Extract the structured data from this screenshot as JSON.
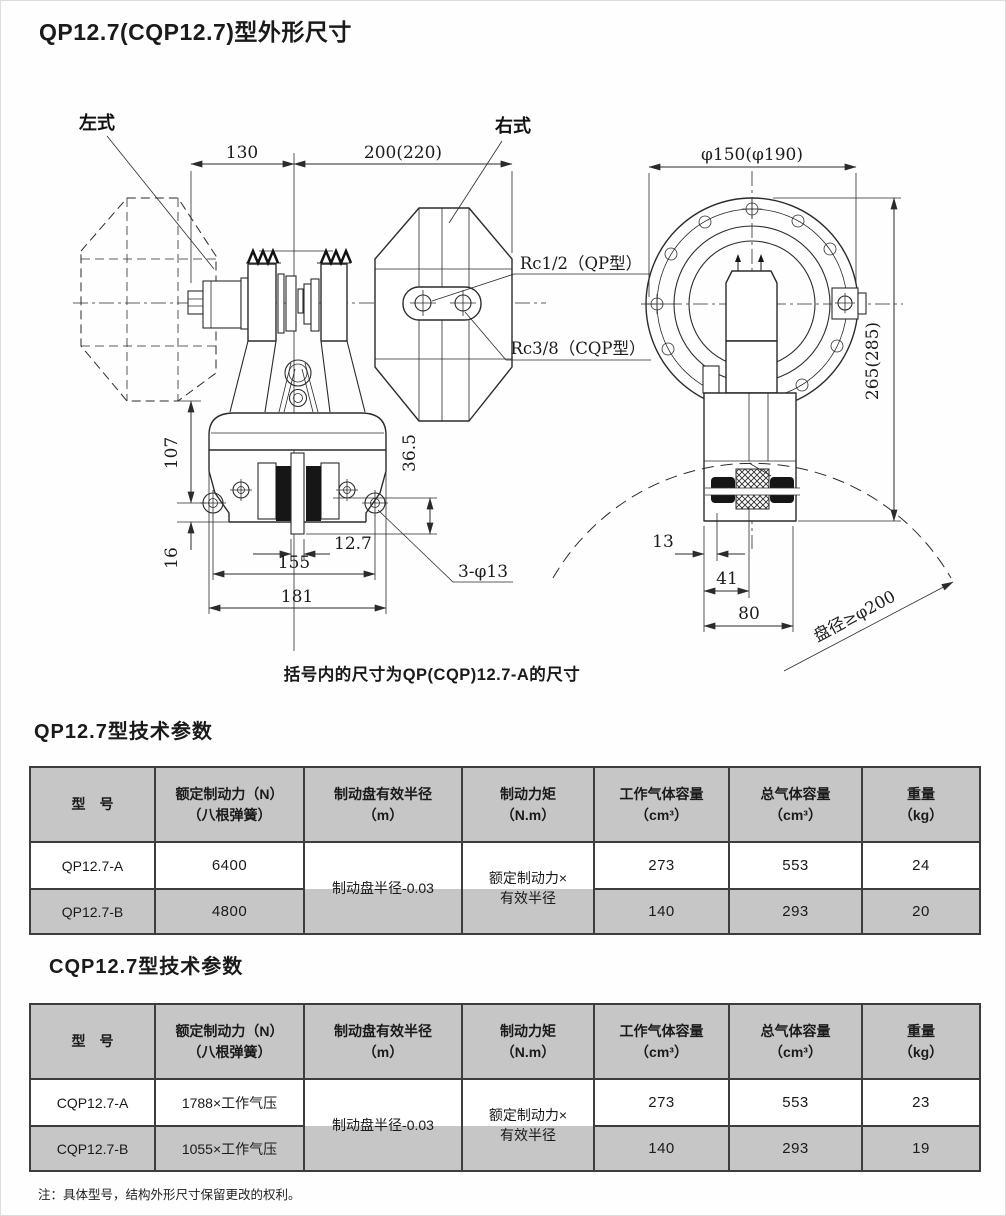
{
  "title": "QP12.7(CQP12.7)型外形尺寸",
  "caption": "括号内的尺寸为QP(CQP)12.7-A的尺寸",
  "footnote": "注：具体型号，结构外形尺寸保留更改的权利。",
  "drawing": {
    "labels": {
      "left_type": "左式",
      "right_type": "右式",
      "rc_qp": "Rc1/2（QP型）",
      "rc_cqp": "Rc3/8（CQP型）",
      "disc_dia": "盘径≥φ200"
    },
    "dims": {
      "w130": "130",
      "w200": "200(220)",
      "h107": "107",
      "h16": "16",
      "w155": "155",
      "w181": "181",
      "w127": "12.7",
      "h365": "36.5",
      "holes": "3-φ13",
      "flange": "φ150(φ190)",
      "h265": "265(285)",
      "b13": "13",
      "b41": "41",
      "b80": "80"
    }
  },
  "tables": [
    {
      "title": "QP12.7型技术参数",
      "headers": [
        {
          "l1": "型　号",
          "l2": ""
        },
        {
          "l1": "额定制动力（N）",
          "l2": "（八根弹簧）"
        },
        {
          "l1": "制动盘有效半径",
          "l2": "（m）"
        },
        {
          "l1": "制动力矩",
          "l2": "（N.m）"
        },
        {
          "l1": "工作气体容量",
          "l2": "（cm³）"
        },
        {
          "l1": "总气体容量",
          "l2": "（cm³）"
        },
        {
          "l1": "重量",
          "l2": "（kg）"
        }
      ],
      "radius_note": "制动盘半径-0.03",
      "torque_note": {
        "l1": "额定制动力×",
        "l2": "有效半径"
      },
      "rows": [
        {
          "model": "QP12.7-A",
          "force": "6400",
          "work_vol": "273",
          "total_vol": "553",
          "weight": "24"
        },
        {
          "model": "QP12.7-B",
          "force": "4800",
          "work_vol": "140",
          "total_vol": "293",
          "weight": "20"
        }
      ]
    },
    {
      "title": "CQP12.7型技术参数",
      "headers": [
        {
          "l1": "型　号",
          "l2": ""
        },
        {
          "l1": "额定制动力（N）",
          "l2": "（八根弹簧）"
        },
        {
          "l1": "制动盘有效半径",
          "l2": "（m）"
        },
        {
          "l1": "制动力矩",
          "l2": "（N.m）"
        },
        {
          "l1": "工作气体容量",
          "l2": "（cm³）"
        },
        {
          "l1": "总气体容量",
          "l2": "（cm³）"
        },
        {
          "l1": "重量",
          "l2": "（kg）"
        }
      ],
      "radius_note": "制动盘半径-0.03",
      "torque_note": {
        "l1": "额定制动力×",
        "l2": "有效半径"
      },
      "rows": [
        {
          "model": "CQP12.7-A",
          "force": "1788×工作气压",
          "work_vol": "273",
          "total_vol": "553",
          "weight": "23"
        },
        {
          "model": "CQP12.7-B",
          "force": "1055×工作气压",
          "work_vol": "140",
          "total_vol": "293",
          "weight": "19"
        }
      ]
    }
  ]
}
